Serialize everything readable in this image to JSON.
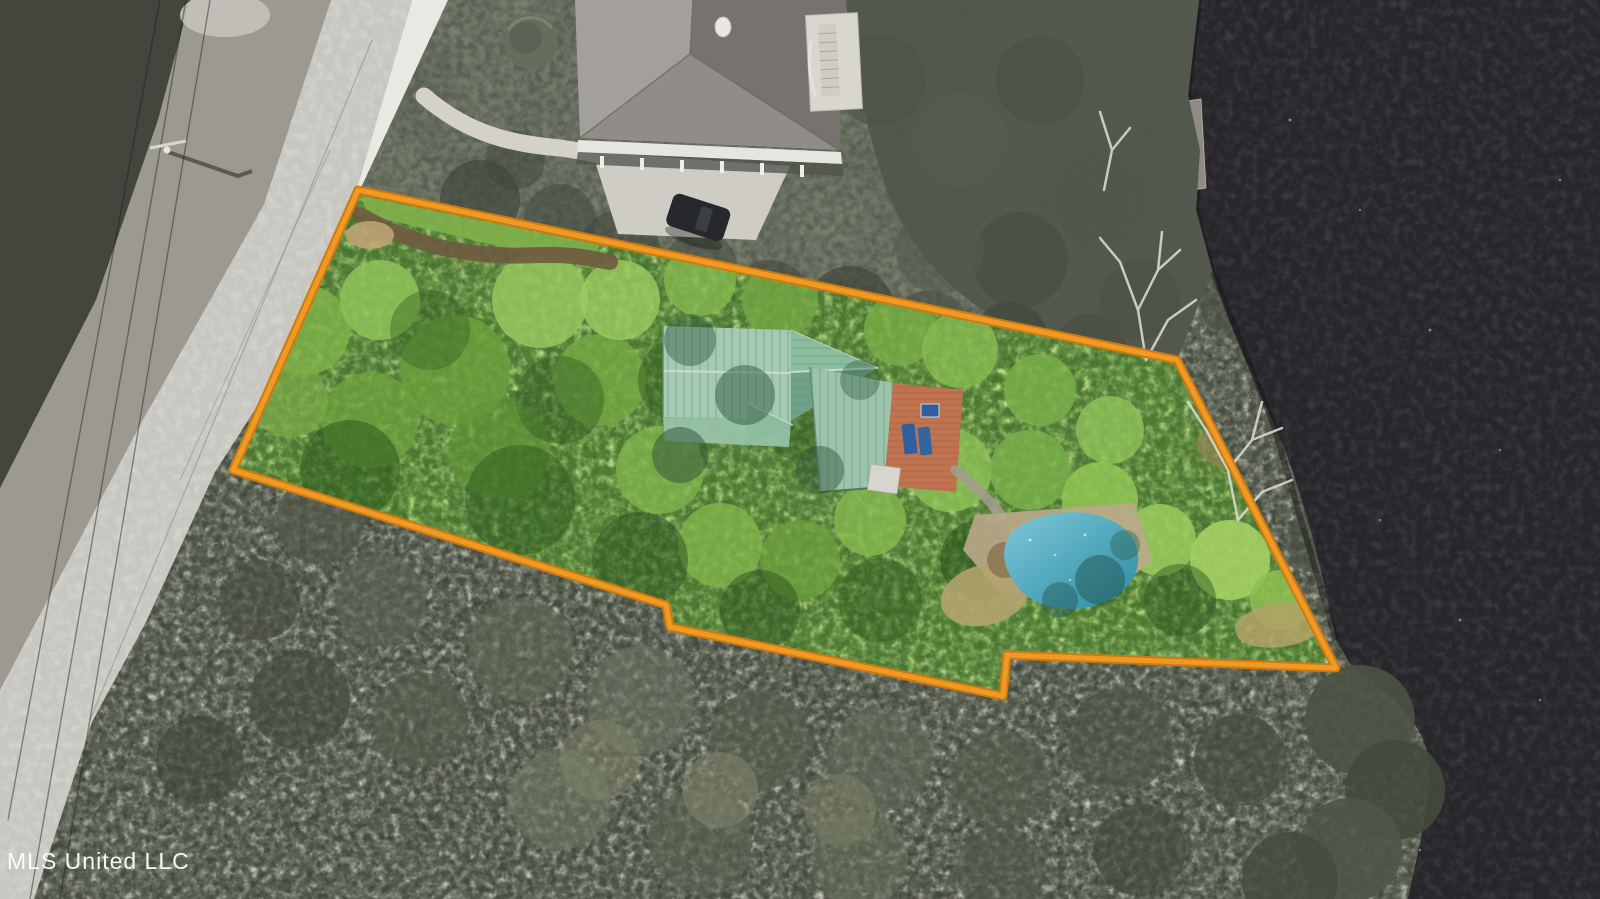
{
  "watermark": {
    "label": "MLS United LLC"
  },
  "colors": {
    "boundary": "#f09a26",
    "boundary_edge": "#cf7a10",
    "water": "#29262b",
    "water_speck": "#cfd0d6",
    "road": "#c8c6c1",
    "road_crack": "#96948f",
    "sidewalk": "#eae8e3",
    "scrub": "#9c9a90",
    "dark_trees": "#42463d",
    "gray_canopy": "#5d6254",
    "lawn": "#7c8171",
    "neighbor_roof_light": "#a3a09b",
    "neighbor_roof_dark": "#76736f",
    "neighbor_roof_front": "#908d89",
    "fascia": "#e7e5e0",
    "deck_white": "#d9d6d0",
    "dock_gray": "#8e8b84",
    "driveway": "#cfccc6",
    "car": "#26282b",
    "lot_green": "#538233",
    "grass_strip": "#7fb04a",
    "dirt": "#6f5a40",
    "dirt_light": "#c3a478",
    "roof_sage": "#a5c9b2",
    "roof_sage_mid": "#9cc3ab",
    "roof_sage_dark": "#6fa288",
    "deck_terracotta": "#bf7350",
    "chair_blue": "#2e5f9e",
    "shed_white": "#d8d5cf",
    "pool_light": "#7ec7d8",
    "pool_dark": "#2b8ba1",
    "pool_deck": "#baa98a",
    "straw": "#b3a36e",
    "branch_white": "#d8d7d1",
    "watermark_white": "#ffffff"
  }
}
